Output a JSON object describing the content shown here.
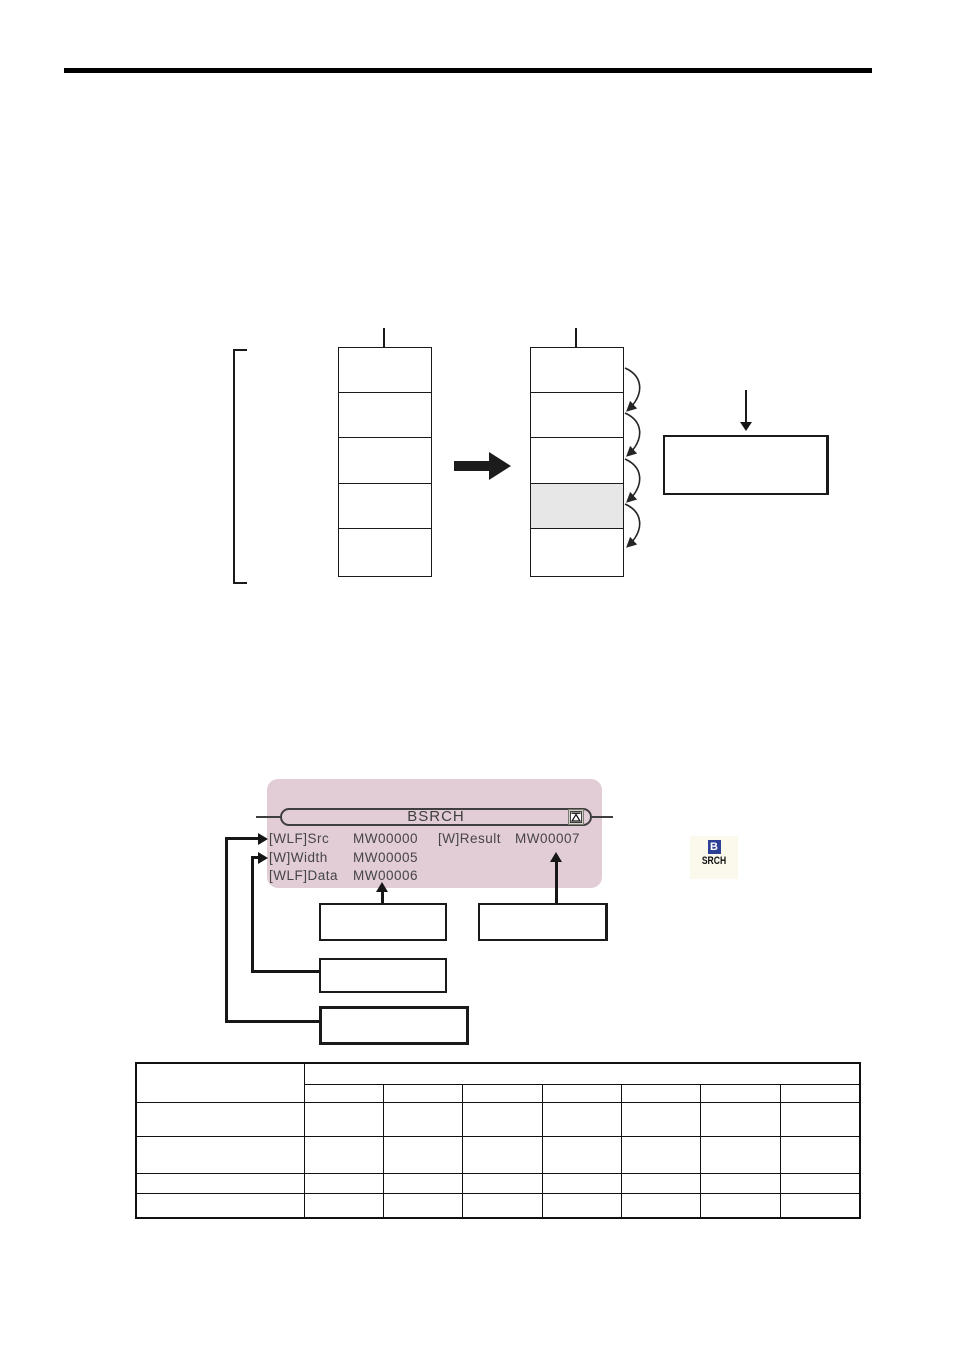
{
  "colors": {
    "block_pink": "#e2ccd6",
    "shaded_cell_gray": "#e7e7e7",
    "icon_blue": "#2e4096",
    "rule_black": "#000000"
  },
  "bsrch_block": {
    "title": "BSRCH",
    "expand_icon": "collapse-triangle-icon",
    "rows": [
      {
        "left_label": "[WLF]Src",
        "left_value": "MW00000",
        "right_label": "[W]Result",
        "right_value": "MW00007"
      },
      {
        "left_label": "[W]Width",
        "left_value": "MW00005"
      },
      {
        "left_label": "[WLF]Data",
        "left_value": "MW00006"
      }
    ]
  },
  "instruction_icon": {
    "top": "B",
    "bottom": "SRCH"
  },
  "diagram": {
    "left_stack_cells": 5,
    "right_stack_cells": 5,
    "right_stack_shaded_cell_index": 3,
    "search_arc_count": 4
  },
  "table": {
    "header_columns": 7,
    "body_rows": 4
  }
}
